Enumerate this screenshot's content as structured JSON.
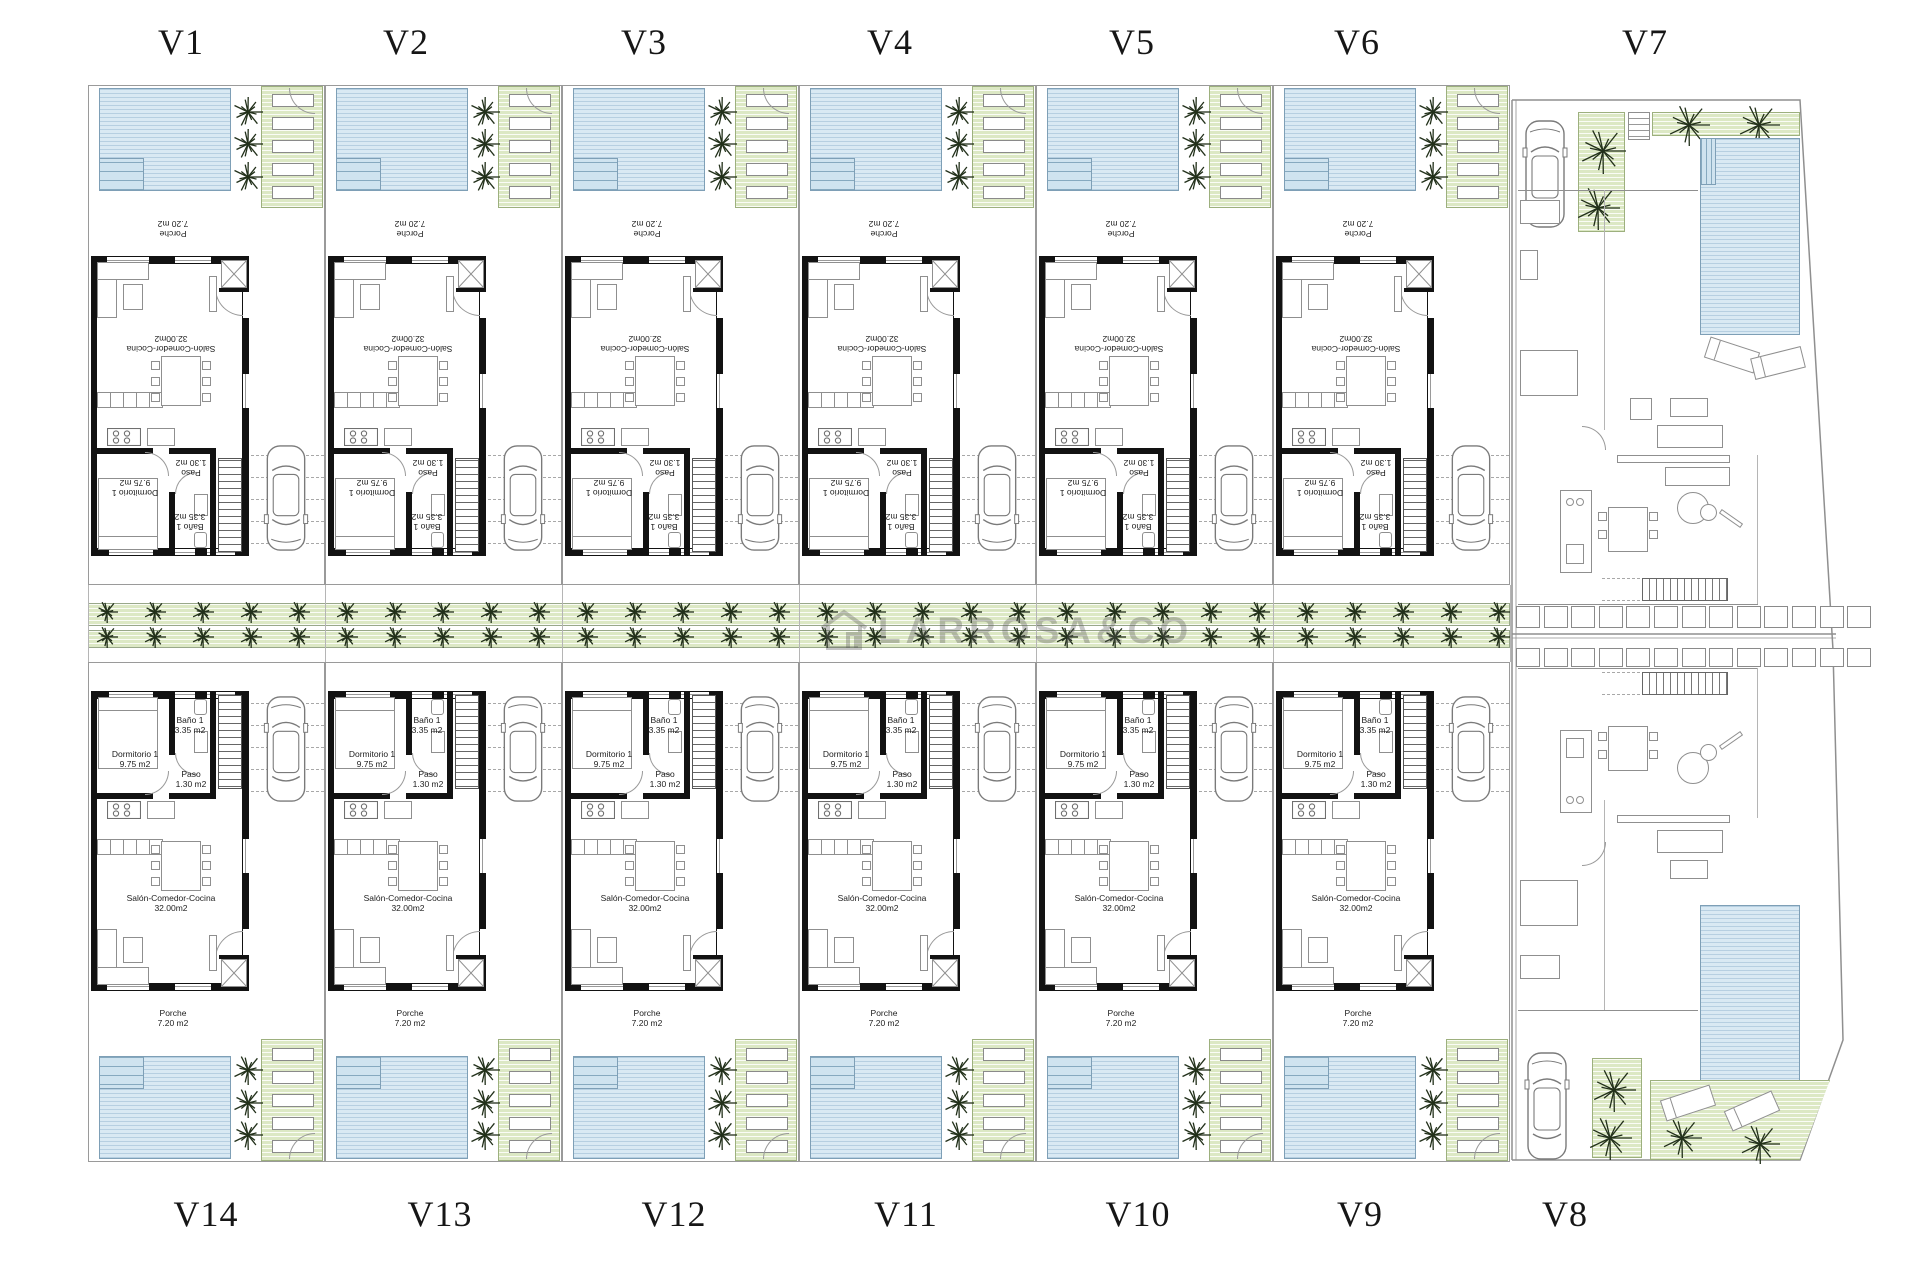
{
  "plan": {
    "type": "residential development site plan, ground floor",
    "units_top_row": [
      "V1",
      "V2",
      "V3",
      "V4",
      "V5",
      "V6",
      "V7"
    ],
    "units_bottom_row": [
      "V14",
      "V13",
      "V12",
      "V11",
      "V10",
      "V9",
      "V8"
    ]
  },
  "watermark": {
    "brand": "LARROSA&CO"
  },
  "labels": {
    "top": [
      {
        "label": "V1"
      },
      {
        "label": "V2"
      },
      {
        "label": "V3"
      },
      {
        "label": "V4"
      },
      {
        "label": "V5"
      },
      {
        "label": "V6"
      },
      {
        "label": "V7"
      }
    ],
    "bottom": [
      {
        "label": "V14"
      },
      {
        "label": "V13"
      },
      {
        "label": "V12"
      },
      {
        "label": "V11"
      },
      {
        "label": "V10"
      },
      {
        "label": "V9"
      },
      {
        "label": "V8"
      }
    ]
  },
  "rooms": {
    "dormitorio": {
      "name": "Dormitorio 1",
      "area": "9.75 m2"
    },
    "bano": {
      "name": "Baño 1",
      "area": "3.35 m2"
    },
    "paso": {
      "name": "Paso",
      "area": "1.30 m2"
    },
    "salon": {
      "name": "Salón-Comedor-Cocina",
      "area": "32.00m2"
    },
    "porche": {
      "name": "Porche",
      "area": "7.20 m2"
    }
  },
  "colors": {
    "pool": "#d9e9f3",
    "pool_line": "#7e9fb6",
    "garden_green": "#dce8c4",
    "garden_line": "#9db07e",
    "wall": "#121212",
    "furniture_line": "#8f8f8f",
    "tree": "#22301a",
    "watermark_gray": "#5a5a5a"
  }
}
